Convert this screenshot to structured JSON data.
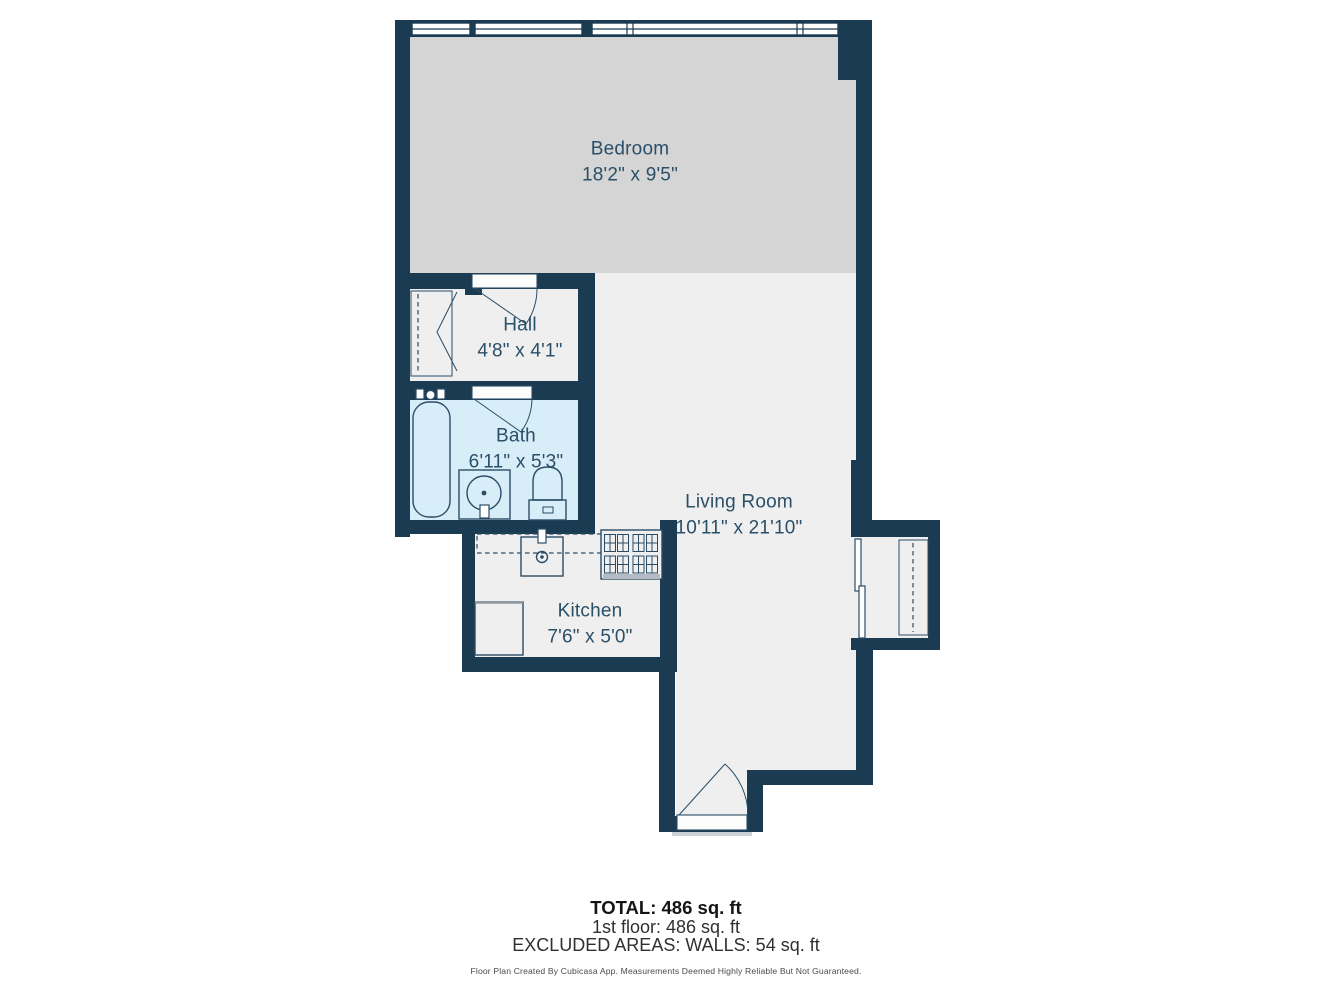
{
  "rooms": [
    {
      "id": "bedroom",
      "name": "Bedroom",
      "dims": "18'2\" x 9'5\""
    },
    {
      "id": "hall",
      "name": "Hall",
      "dims": "4'8\" x 4'1\""
    },
    {
      "id": "bath",
      "name": "Bath",
      "dims": "6'11\" x 5'3\""
    },
    {
      "id": "living-room",
      "name": "Living Room",
      "dims": "10'11\" x 21'10\""
    },
    {
      "id": "kitchen",
      "name": "Kitchen",
      "dims": "7'6\" x 5'0\""
    }
  ],
  "summary": {
    "total": "TOTAL: 486 sq. ft",
    "first_floor": "1st floor: 486 sq. ft",
    "excluded": "EXCLUDED AREAS: WALLS: 54 sq. ft"
  },
  "footer_note": "Floor Plan Created By Cubicasa App. Measurements Deemed Highly Reliable But Not Guaranteed.",
  "colors": {
    "wall": "#1b3b53",
    "room": "#efefef",
    "bedroom": "#d5d5d5",
    "bath": "#d7edf8",
    "fixture": "#2b4c66",
    "label": "#2a4f68"
  }
}
